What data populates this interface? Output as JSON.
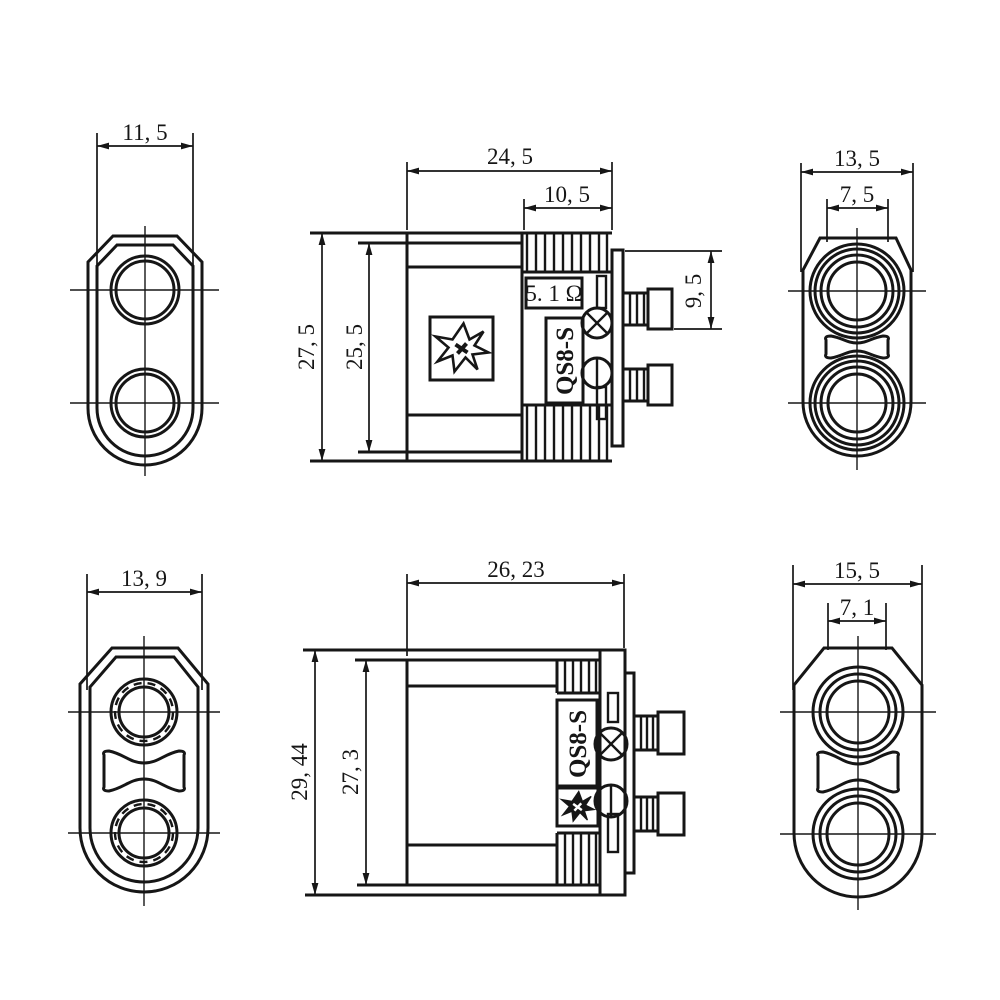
{
  "part": {
    "model": "QS8-S",
    "type_note": "anti-spark connector engineering drawing, six orthographic views"
  },
  "views": {
    "top_left": {
      "dim_width": "11, 5"
    },
    "top_middle": {
      "dim_overall_width": "24, 5",
      "dim_grip_width": "10, 5",
      "dim_overall_height": "27, 5",
      "dim_body_height": "25, 5",
      "dim_pin_drop": "9, 5",
      "label_resistor": "5. 1 Ω",
      "label_model": "QS8-S"
    },
    "top_right": {
      "dim_width": "13, 5",
      "dim_hole_pitch": "7, 5"
    },
    "bottom_left": {
      "dim_width": "13, 9"
    },
    "bottom_middle": {
      "dim_overall_width": "26, 23",
      "dim_overall_height": "29, 44",
      "dim_body_height": "27, 3",
      "label_model": "QS8-S"
    },
    "bottom_right": {
      "dim_width": "15, 5",
      "dim_hole_pitch": "7, 1"
    }
  },
  "colors": {
    "line": "#161616",
    "background": "#ffffff"
  }
}
